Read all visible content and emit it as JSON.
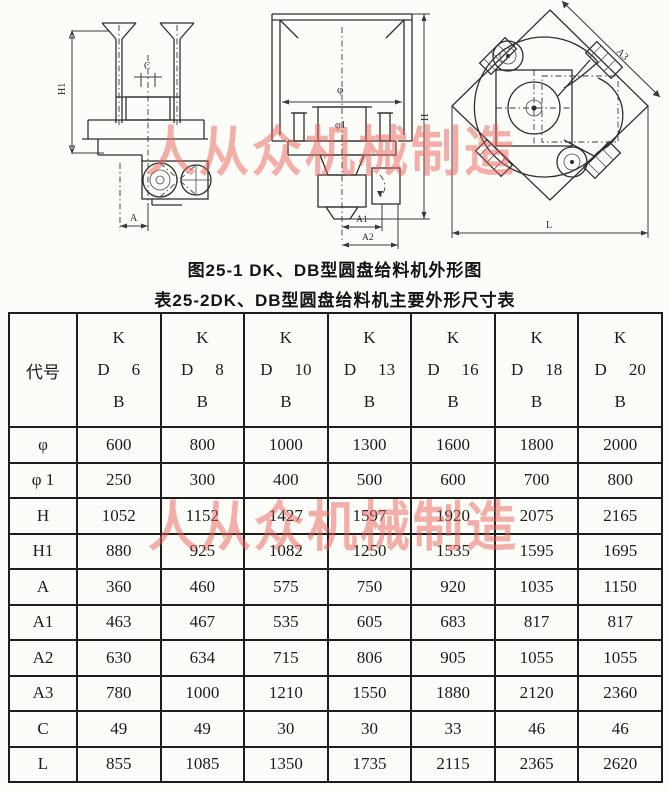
{
  "watermark": {
    "text": "人从众机械制造",
    "color": "#e96058"
  },
  "figure": {
    "caption_fig": "图25-1 DK、DB型圆盘给料机外形图",
    "caption_table": "表25-2DK、DB型圆盘给料机主要外形尺寸表",
    "labels": {
      "front": {
        "h1": "H1",
        "c": "C",
        "a": "A"
      },
      "side": {
        "phi": "φ",
        "phi1": "φ1",
        "h": "H",
        "a1": "A1",
        "a2": "A2"
      },
      "top": {
        "a3": "A3",
        "l": "L"
      }
    }
  },
  "table": {
    "code_header": "代号",
    "models": [
      {
        "k": "K",
        "d": "D",
        "size": "6",
        "b": "B"
      },
      {
        "k": "K",
        "d": "D",
        "size": "8",
        "b": "B"
      },
      {
        "k": "K",
        "d": "D",
        "size": "10",
        "b": "B"
      },
      {
        "k": "K",
        "d": "D",
        "size": "13",
        "b": "B"
      },
      {
        "k": "K",
        "d": "D",
        "size": "16",
        "b": "B"
      },
      {
        "k": "K",
        "d": "D",
        "size": "18",
        "b": "B"
      },
      {
        "k": "K",
        "d": "D",
        "size": "20",
        "b": "B"
      }
    ],
    "rows": [
      {
        "label": "φ",
        "values": [
          "600",
          "800",
          "1000",
          "1300",
          "1600",
          "1800",
          "2000"
        ]
      },
      {
        "label": "φ 1",
        "values": [
          "250",
          "300",
          "400",
          "500",
          "600",
          "700",
          "800"
        ]
      },
      {
        "label": "H",
        "values": [
          "1052",
          "1152",
          "1427",
          "1597",
          "1920",
          "2075",
          "2165"
        ]
      },
      {
        "label": "H1",
        "values": [
          "880",
          "925",
          "1082",
          "1250",
          "1535",
          "1595",
          "1695"
        ]
      },
      {
        "label": "A",
        "values": [
          "360",
          "460",
          "575",
          "750",
          "920",
          "1035",
          "1150"
        ]
      },
      {
        "label": "A1",
        "values": [
          "463",
          "467",
          "535",
          "605",
          "683",
          "817",
          "817"
        ]
      },
      {
        "label": "A2",
        "values": [
          "630",
          "634",
          "715",
          "806",
          "905",
          "1055",
          "1055"
        ]
      },
      {
        "label": "A3",
        "values": [
          "780",
          "1000",
          "1210",
          "1550",
          "1880",
          "2120",
          "2360"
        ]
      },
      {
        "label": "C",
        "values": [
          "49",
          "49",
          "30",
          "30",
          "33",
          "46",
          "46"
        ]
      },
      {
        "label": "L",
        "values": [
          "855",
          "1085",
          "1350",
          "1735",
          "2115",
          "2365",
          "2620"
        ]
      }
    ]
  }
}
